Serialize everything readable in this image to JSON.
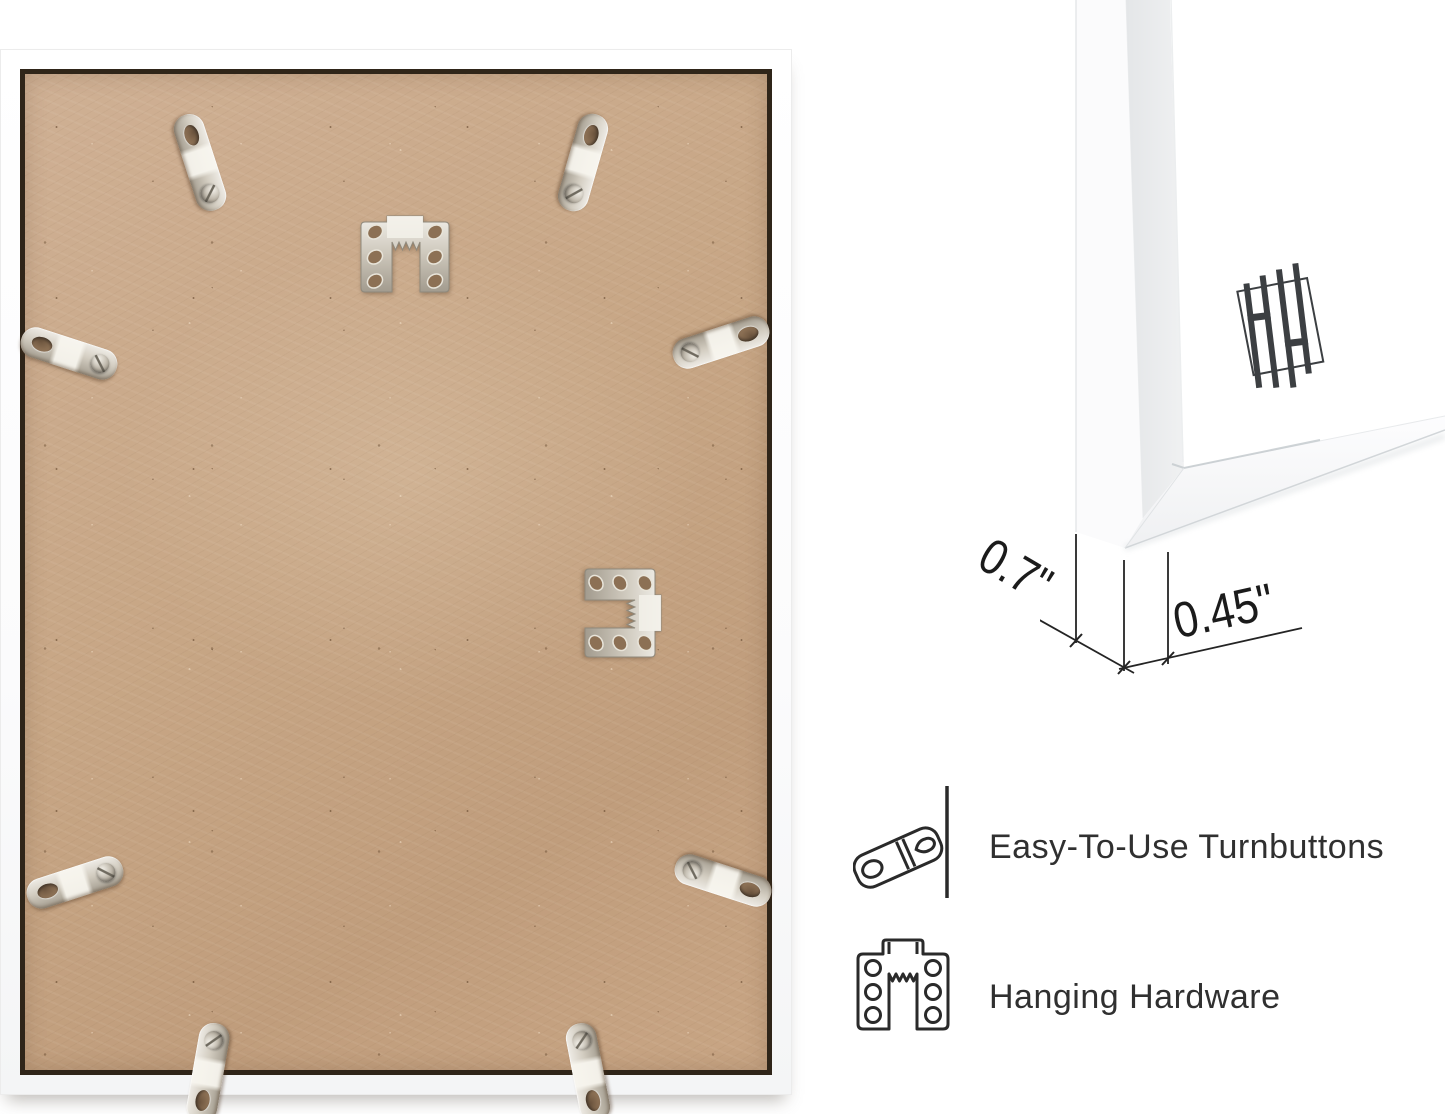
{
  "image_type": "product-detail-annotated-photo",
  "photo": {
    "subject": "back of white picture frame with MDF board",
    "hardware_icons": [
      "turnbutton-clip",
      "sawtooth-hanger"
    ],
    "turnbutton_count": 8,
    "hanger_count": 2
  },
  "corner_detail": {
    "subject": "front corner of white frame profile",
    "logo_icon": "brand-logo-hh-bars"
  },
  "dimension_annotations": {
    "frame_depth": "0.7\"",
    "frame_face_width": "0.45\""
  },
  "features": [
    {
      "icon": "turnbutton-icon",
      "label": "Easy-To-Use Turnbuttons"
    },
    {
      "icon": "hanging-hardware-icon",
      "label": "Hanging Hardware"
    }
  ],
  "colors": {
    "background": "#ffffff",
    "board_tan": "#c9a98b",
    "board_gap": "#2f2519",
    "metal_light": "#efece6",
    "metal_dark": "#a39c8f",
    "line_dark": "#222222",
    "text_dark": "#303030",
    "logo_gray": "#3c3f42",
    "frame_side_gray": "#e7e9ea"
  }
}
